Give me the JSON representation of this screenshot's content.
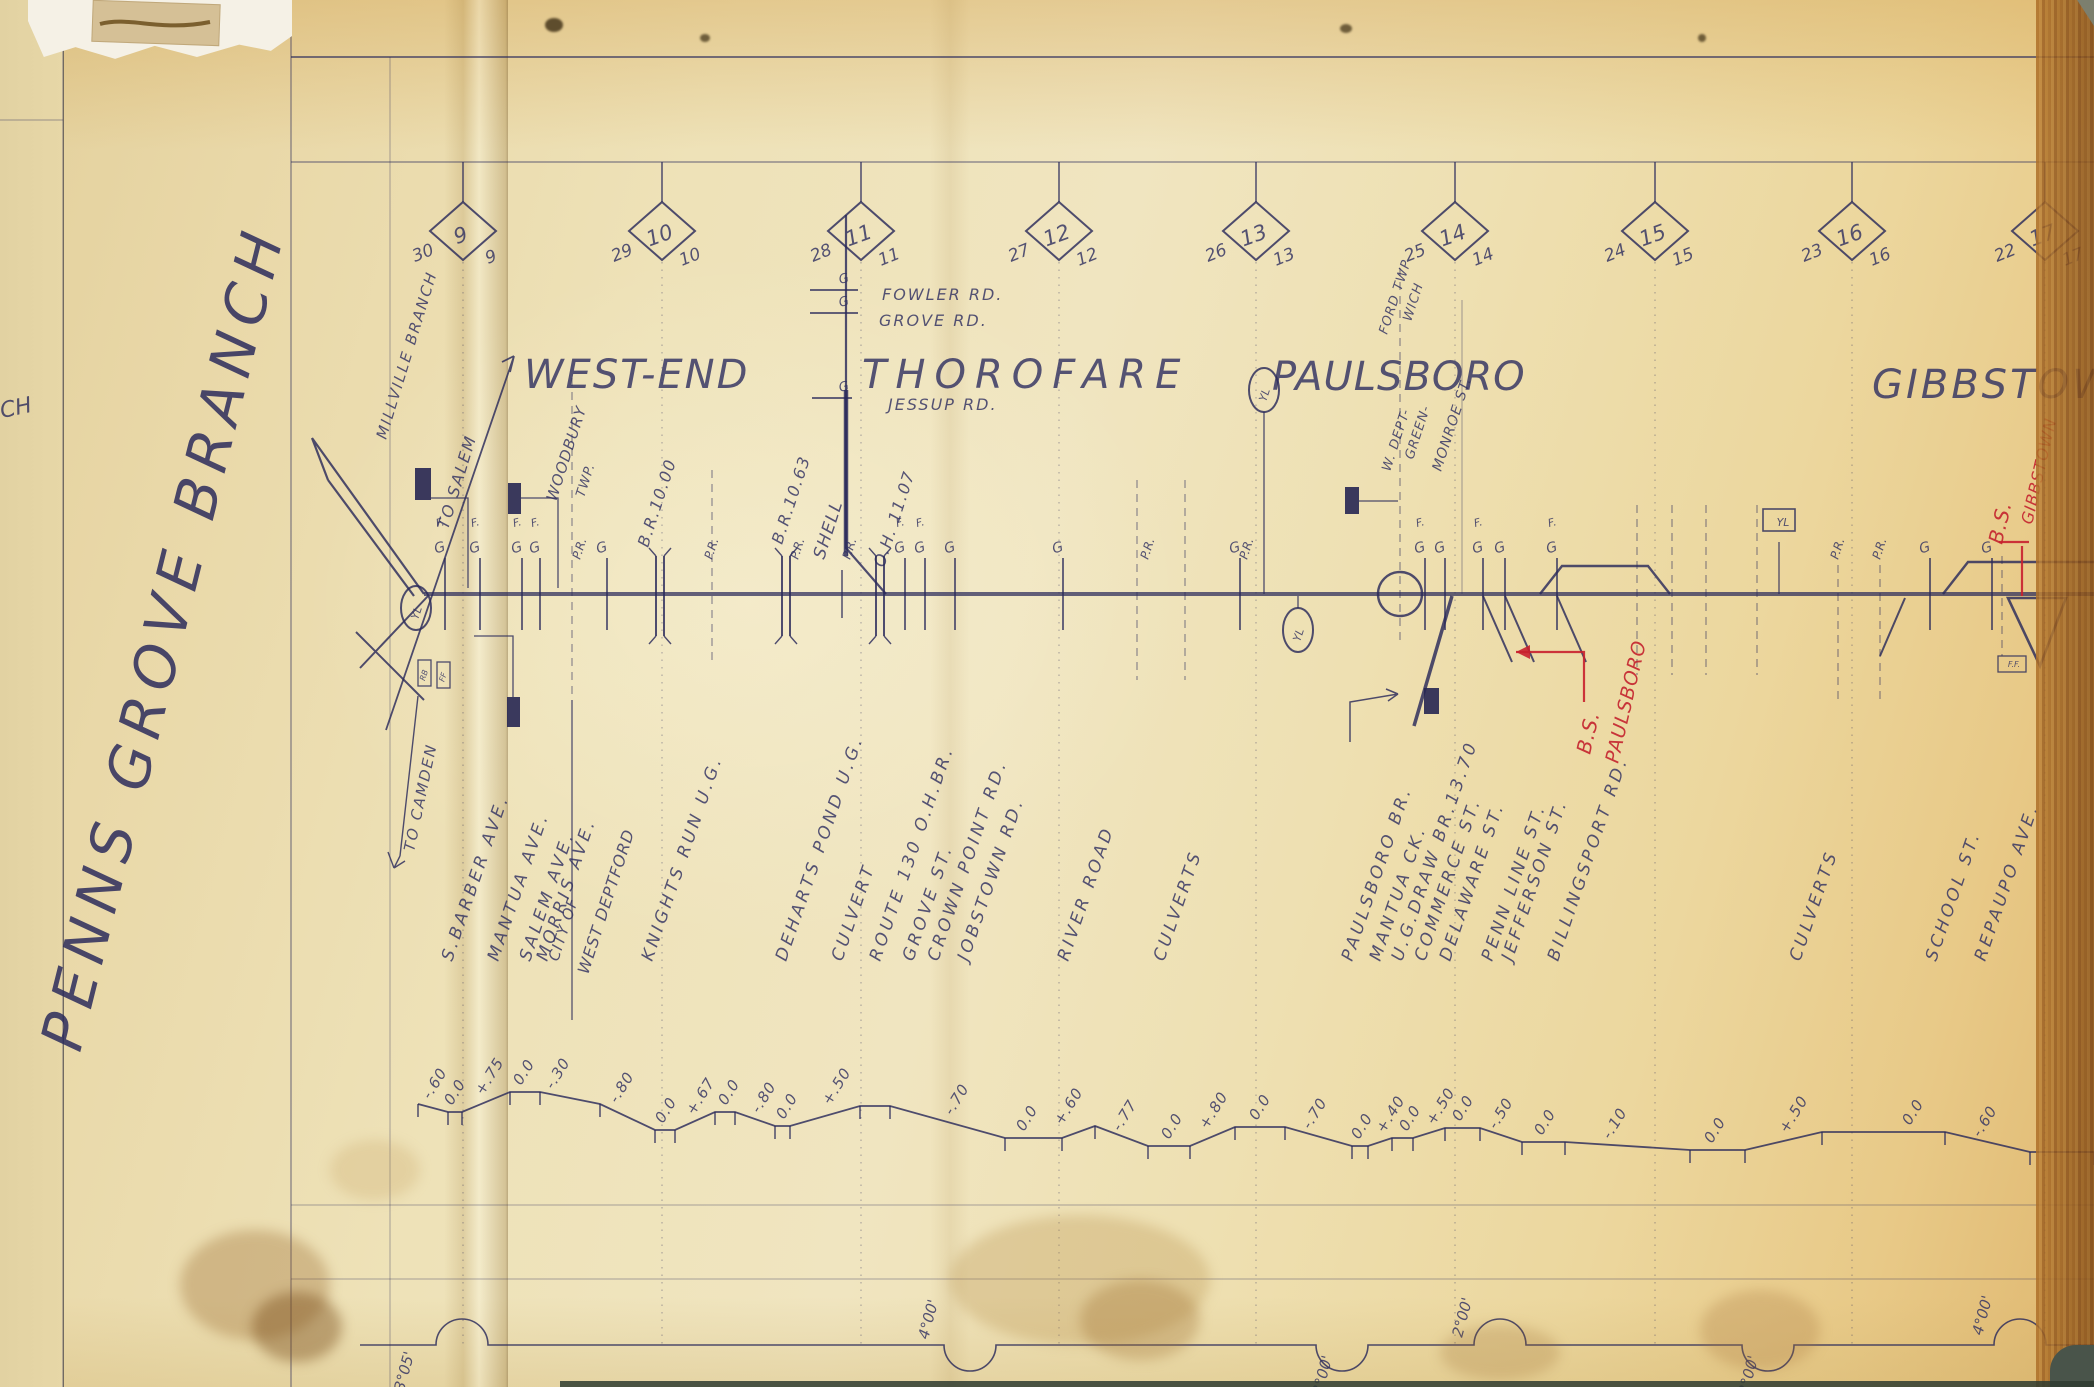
{
  "page": {
    "branch_title": "PENNS GROVE BRANCH",
    "left_page_fragment": "CH",
    "ink_color": "#323262",
    "red_color": "#c4232e",
    "paper_color": "#eee2b8"
  },
  "symbols": {
    "gate": "G",
    "flag": "F.",
    "yard_limit": "YL"
  },
  "mileposts": [
    {
      "mile": "9",
      "left_no": "30",
      "right_no": "9",
      "x": 463
    },
    {
      "mile": "10",
      "left_no": "29",
      "right_no": "10",
      "x": 662
    },
    {
      "mile": "11",
      "left_no": "28",
      "right_no": "11",
      "x": 861
    },
    {
      "mile": "12",
      "left_no": "27",
      "right_no": "12",
      "x": 1059
    },
    {
      "mile": "13",
      "left_no": "26",
      "right_no": "13",
      "x": 1256
    },
    {
      "mile": "14",
      "left_no": "25",
      "right_no": "14",
      "x": 1455
    },
    {
      "mile": "15",
      "left_no": "24",
      "right_no": "15",
      "x": 1655
    },
    {
      "mile": "16",
      "left_no": "23",
      "right_no": "16",
      "x": 1852
    },
    {
      "mile": "17",
      "left_no": "22",
      "right_no": "17",
      "x": 2045
    }
  ],
  "stations": [
    {
      "name": "WEST-END",
      "x": 524,
      "y": 388,
      "size": 40,
      "ls": 2
    },
    {
      "name": "THOROFARE",
      "x": 862,
      "y": 388,
      "size": 40,
      "ls": 9
    },
    {
      "name": "PAULSBORO",
      "x": 1272,
      "y": 390,
      "size": 40,
      "ls": 1
    },
    {
      "name": "GIBBSTOWN",
      "x": 1872,
      "y": 398,
      "size": 40,
      "ls": 3
    }
  ],
  "direction_labels": {
    "millville": "MILLVILLE BRANCH",
    "to_salem": "TO SALEM",
    "to_camden": "TO CAMDEN"
  },
  "top_roads": [
    {
      "name": "FOWLER RD.",
      "x": 882,
      "y": 300,
      "tick_y": 290
    },
    {
      "name": "GROVE RD.",
      "x": 879,
      "y": 326,
      "tick_y": 313
    },
    {
      "name": "JESSUP RD.",
      "x": 888,
      "y": 410,
      "tick_y": 398
    }
  ],
  "boundary_labels": [
    {
      "text": "WOODBURY",
      "x": 556,
      "y": 502,
      "size": 15
    },
    {
      "text": "TWP.",
      "x": 584,
      "y": 498,
      "size": 13
    },
    {
      "text": "W. DEPT-",
      "x": 1390,
      "y": 472,
      "size": 13
    },
    {
      "text": "FORD TWP",
      "x": 1387,
      "y": 335,
      "size": 13
    },
    {
      "text": "GREEN-",
      "x": 1413,
      "y": 460,
      "size": 13
    },
    {
      "text": "WICH",
      "x": 1411,
      "y": 322,
      "size": 13
    },
    {
      "text": "MONROE ST.",
      "x": 1441,
      "y": 472,
      "size": 14
    },
    {
      "text": "CITY OF",
      "x": 558,
      "y": 962,
      "size": 15
    },
    {
      "text": "WEST DEPTFORD",
      "x": 588,
      "y": 975,
      "size": 16
    }
  ],
  "bridge_labels": [
    {
      "text": "B.R.10.00",
      "x": 648,
      "y": 548,
      "size": 16
    },
    {
      "text": "B.R.10.63",
      "x": 782,
      "y": 545,
      "size": 16
    },
    {
      "text": "O.H. 11.07",
      "x": 884,
      "y": 568,
      "size": 16
    },
    {
      "text": "SHELL",
      "x": 824,
      "y": 560,
      "size": 17
    }
  ],
  "feature_labels": [
    {
      "text": "S.BARBER AVE.",
      "x": 452
    },
    {
      "text": "MANTUA AVE.",
      "x": 498
    },
    {
      "text": "SALEM AVE.",
      "x": 530
    },
    {
      "text": "MORRIS AVE.",
      "x": 547
    },
    {
      "text": "KNIGHTS RUN U.G.",
      "x": 652
    },
    {
      "text": "DEHARTS POND U.G.",
      "x": 786
    },
    {
      "text": "CULVERT",
      "x": 842
    },
    {
      "text": "ROUTE 130 O.H.BR.",
      "x": 880
    },
    {
      "text": "GROVE ST.",
      "x": 913
    },
    {
      "text": "CROWN POINT RD.",
      "x": 938
    },
    {
      "text": "JOBSTOWN RD.",
      "x": 968
    },
    {
      "text": "RIVER ROAD",
      "x": 1068
    },
    {
      "text": "CULVERTS",
      "x": 1164
    },
    {
      "text": "PAULSBORO BR.",
      "x": 1352
    },
    {
      "text": "MANTUA CK.",
      "x": 1380
    },
    {
      "text": "U.G.DRAW BR.13.70",
      "x": 1402
    },
    {
      "text": "COMMERCE ST.",
      "x": 1425
    },
    {
      "text": "DELAWARE ST.",
      "x": 1450
    },
    {
      "text": "PENN LINE ST.",
      "x": 1492
    },
    {
      "text": "JEFFERSON ST.",
      "x": 1512
    },
    {
      "text": "BILLINGSPORT RD.",
      "x": 1558
    },
    {
      "text": "CULVERTS",
      "x": 1800
    },
    {
      "text": "SCHOOL ST.",
      "x": 1936
    },
    {
      "text": "REPAUPO AVE.",
      "x": 1985
    }
  ],
  "red_annotations": [
    {
      "lines": [
        {
          "t": "B.S.",
          "x": 1590,
          "y": 755,
          "size": 20
        },
        {
          "t": "PAULSBORO",
          "x": 1618,
          "y": 764,
          "size": 19
        }
      ],
      "path": "M1584,702 L1584,652 L1516,652",
      "arrow": [
        [
          1516,
          652
        ],
        [
          1530,
          645
        ],
        [
          1530,
          659
        ]
      ]
    },
    {
      "lines": [
        {
          "t": "B.S.",
          "x": 2002,
          "y": 545,
          "size": 20
        },
        {
          "t": "GIBBSTOWN",
          "x": 2032,
          "y": 525,
          "size": 16
        }
      ],
      "path": "M1999,542 L2029,542 M2022,546 L2022,596",
      "arrow": null
    }
  ],
  "crossings": [
    {
      "x": 445,
      "f": true
    },
    {
      "x": 480,
      "f": true
    },
    {
      "x": 522,
      "f": true
    },
    {
      "x": 540,
      "f": true
    },
    {
      "x": 607
    },
    {
      "x": 905,
      "f": true
    },
    {
      "x": 925,
      "f": true
    },
    {
      "x": 955
    },
    {
      "x": 1063
    },
    {
      "x": 1240
    },
    {
      "x": 1425,
      "f": true
    },
    {
      "x": 1445
    },
    {
      "x": 1483,
      "f": true
    },
    {
      "x": 1505
    },
    {
      "x": 1557,
      "f": true
    },
    {
      "x": 1930
    },
    {
      "x": 1992
    }
  ],
  "pr_labels": [
    580,
    712,
    798,
    850,
    1148,
    1247,
    1838,
    1880
  ],
  "dashed_lines": [
    {
      "x": 572,
      "y1": 378,
      "y2": 695
    },
    {
      "x": 712,
      "y1": 470,
      "y2": 660
    },
    {
      "x": 1137,
      "y1": 480,
      "y2": 680
    },
    {
      "x": 1185,
      "y1": 480,
      "y2": 680
    },
    {
      "x": 1400,
      "y1": 268,
      "y2": 640
    },
    {
      "x": 1637,
      "y1": 505,
      "y2": 675
    },
    {
      "x": 1672,
      "y1": 505,
      "y2": 675
    },
    {
      "x": 1706,
      "y1": 505,
      "y2": 675
    },
    {
      "x": 1757,
      "y1": 505,
      "y2": 675
    },
    {
      "x": 1838,
      "y1": 565,
      "y2": 700
    },
    {
      "x": 1880,
      "y1": 565,
      "y2": 700
    },
    {
      "x": 2002,
      "y1": 556,
      "y2": 656
    }
  ],
  "ug_bridges": [
    660,
    786,
    880
  ],
  "culvert_ticks": [
    842
  ],
  "yl_markers": [
    {
      "shape": "oval",
      "x": 416,
      "y": 608,
      "label": "YL",
      "post_to": null
    },
    {
      "shape": "oval",
      "x": 1264,
      "y": 390,
      "label": "YL",
      "post_to": 594
    },
    {
      "shape": "oval",
      "x": 1298,
      "y": 630,
      "label": "YL",
      "post_to": 596
    },
    {
      "shape": "box",
      "x": 1779,
      "y": 520,
      "label": "YL",
      "post_to": 594
    }
  ],
  "buildings": [
    [
      415,
      468,
      16,
      32
    ],
    [
      508,
      483,
      13,
      31
    ],
    [
      507,
      697,
      13,
      30
    ],
    [
      1345,
      487,
      14,
      27
    ],
    [
      1424,
      688,
      15,
      26
    ]
  ],
  "small_boxes": [
    {
      "x": 418,
      "y": 660,
      "w": 13,
      "h": 26,
      "label": "RB"
    },
    {
      "x": 437,
      "y": 662,
      "w": 13,
      "h": 26,
      "label": "FF"
    },
    {
      "x": 1998,
      "y": 656,
      "w": 28,
      "h": 16,
      "label": "F.F."
    }
  ],
  "grades": [
    {
      "v": "-.60",
      "x": 430,
      "y": 1100
    },
    {
      "v": "0.0",
      "x": 452,
      "y": 1106
    },
    {
      "v": "+.75",
      "x": 483,
      "y": 1096
    },
    {
      "v": "0.0",
      "x": 521,
      "y": 1086
    },
    {
      "v": "-.30",
      "x": 553,
      "y": 1090
    },
    {
      "v": "-.80",
      "x": 617,
      "y": 1104
    },
    {
      "v": "0.0",
      "x": 663,
      "y": 1124
    },
    {
      "v": "+.67",
      "x": 694,
      "y": 1116
    },
    {
      "v": "0.0",
      "x": 726,
      "y": 1106
    },
    {
      "v": "-.80",
      "x": 759,
      "y": 1114
    },
    {
      "v": "0.0",
      "x": 784,
      "y": 1120
    },
    {
      "v": "+.50",
      "x": 830,
      "y": 1106
    },
    {
      "v": "-.70",
      "x": 952,
      "y": 1116
    },
    {
      "v": "0.0",
      "x": 1024,
      "y": 1132
    },
    {
      "v": "+.60",
      "x": 1062,
      "y": 1126
    },
    {
      "v": "-.77",
      "x": 1120,
      "y": 1132
    },
    {
      "v": "0.0",
      "x": 1169,
      "y": 1140
    },
    {
      "v": "+.80",
      "x": 1207,
      "y": 1130
    },
    {
      "v": "0.0",
      "x": 1257,
      "y": 1121
    },
    {
      "v": "-.70",
      "x": 1310,
      "y": 1130
    },
    {
      "v": "0.0",
      "x": 1359,
      "y": 1140
    },
    {
      "v": "+.40",
      "x": 1384,
      "y": 1134
    },
    {
      "v": "0.0",
      "x": 1407,
      "y": 1132
    },
    {
      "v": "+.50",
      "x": 1434,
      "y": 1126
    },
    {
      "v": "0.0",
      "x": 1460,
      "y": 1122
    },
    {
      "v": "-.50",
      "x": 1496,
      "y": 1130
    },
    {
      "v": "0.0",
      "x": 1542,
      "y": 1136
    },
    {
      "v": "-.10",
      "x": 1610,
      "y": 1140
    },
    {
      "v": "0.0",
      "x": 1712,
      "y": 1144
    },
    {
      "v": "+.50",
      "x": 1787,
      "y": 1134
    },
    {
      "v": "0.0",
      "x": 1910,
      "y": 1126
    },
    {
      "v": "-.60",
      "x": 1980,
      "y": 1138
    }
  ],
  "profile_points": [
    [
      418,
      1104
    ],
    [
      448,
      1112
    ],
    [
      462,
      1112
    ],
    [
      510,
      1092
    ],
    [
      540,
      1092
    ],
    [
      600,
      1104
    ],
    [
      655,
      1130
    ],
    [
      675,
      1130
    ],
    [
      715,
      1112
    ],
    [
      735,
      1112
    ],
    [
      775,
      1126
    ],
    [
      790,
      1126
    ],
    [
      860,
      1106
    ],
    [
      890,
      1106
    ],
    [
      1005,
      1138
    ],
    [
      1062,
      1138
    ],
    [
      1095,
      1126
    ],
    [
      1148,
      1146
    ],
    [
      1190,
      1146
    ],
    [
      1235,
      1127
    ],
    [
      1285,
      1127
    ],
    [
      1352,
      1146
    ],
    [
      1368,
      1146
    ],
    [
      1392,
      1138
    ],
    [
      1413,
      1138
    ],
    [
      1445,
      1128
    ],
    [
      1480,
      1128
    ],
    [
      1522,
      1142
    ],
    [
      1565,
      1142
    ],
    [
      1690,
      1150
    ],
    [
      1745,
      1150
    ],
    [
      1822,
      1132
    ],
    [
      1945,
      1132
    ],
    [
      2030,
      1152
    ],
    [
      2094,
      1152
    ]
  ],
  "curves": [
    {
      "label": "3°05'",
      "x": 462,
      "dir": "up",
      "lx": 404,
      "ly": 1392
    },
    {
      "label": "4°00'",
      "x": 970,
      "dir": "down",
      "lx": 928,
      "ly": 1340
    },
    {
      "label": "3°00'",
      "x": 1342,
      "dir": "down",
      "lx": 1322,
      "ly": 1396
    },
    {
      "label": "2°00'",
      "x": 1500,
      "dir": "up",
      "lx": 1462,
      "ly": 1338
    },
    {
      "label": "2°00'",
      "x": 1768,
      "dir": "down",
      "lx": 1748,
      "ly": 1396
    },
    {
      "label": "4°00'",
      "x": 2020,
      "dir": "up",
      "lx": 1982,
      "ly": 1336
    }
  ]
}
